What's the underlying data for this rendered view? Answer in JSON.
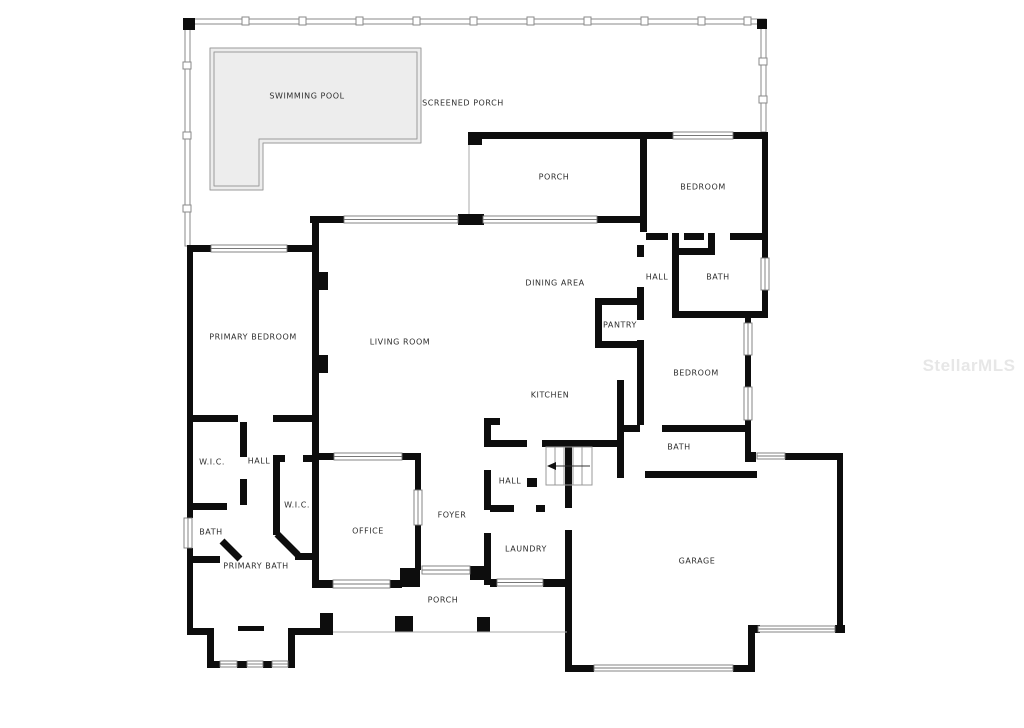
{
  "watermark": "StellarMLS",
  "colors": {
    "wall": "#0d0d0d",
    "pool_fill": "#ededed",
    "pool_edge": "#9a9a9a",
    "screen": "#8a8a8a"
  },
  "labels": {
    "swimming_pool": "SWIMMING POOL",
    "screened_porch": "SCREENED PORCH",
    "porch_top": "PORCH",
    "bedroom_top": "BEDROOM",
    "hall_top": "HALL",
    "bath_top": "BATH",
    "dining_area": "DINING AREA",
    "pantry": "PANTRY",
    "primary_bedroom": "PRIMARY BEDROOM",
    "living_room": "LIVING ROOM",
    "bedroom_right": "BEDROOM",
    "kitchen": "KITCHEN",
    "bath_right": "BATH",
    "wic_left": "W.I.C.",
    "hall_left": "HALL",
    "wic_center": "W.I.C.",
    "hall_center": "HALL",
    "foyer": "FOYER",
    "bath_left": "BATH",
    "office": "OFFICE",
    "laundry": "LAUNDRY",
    "primary_bath": "PRIMARY BATH",
    "garage": "GARAGE",
    "porch_bottom": "PORCH"
  }
}
